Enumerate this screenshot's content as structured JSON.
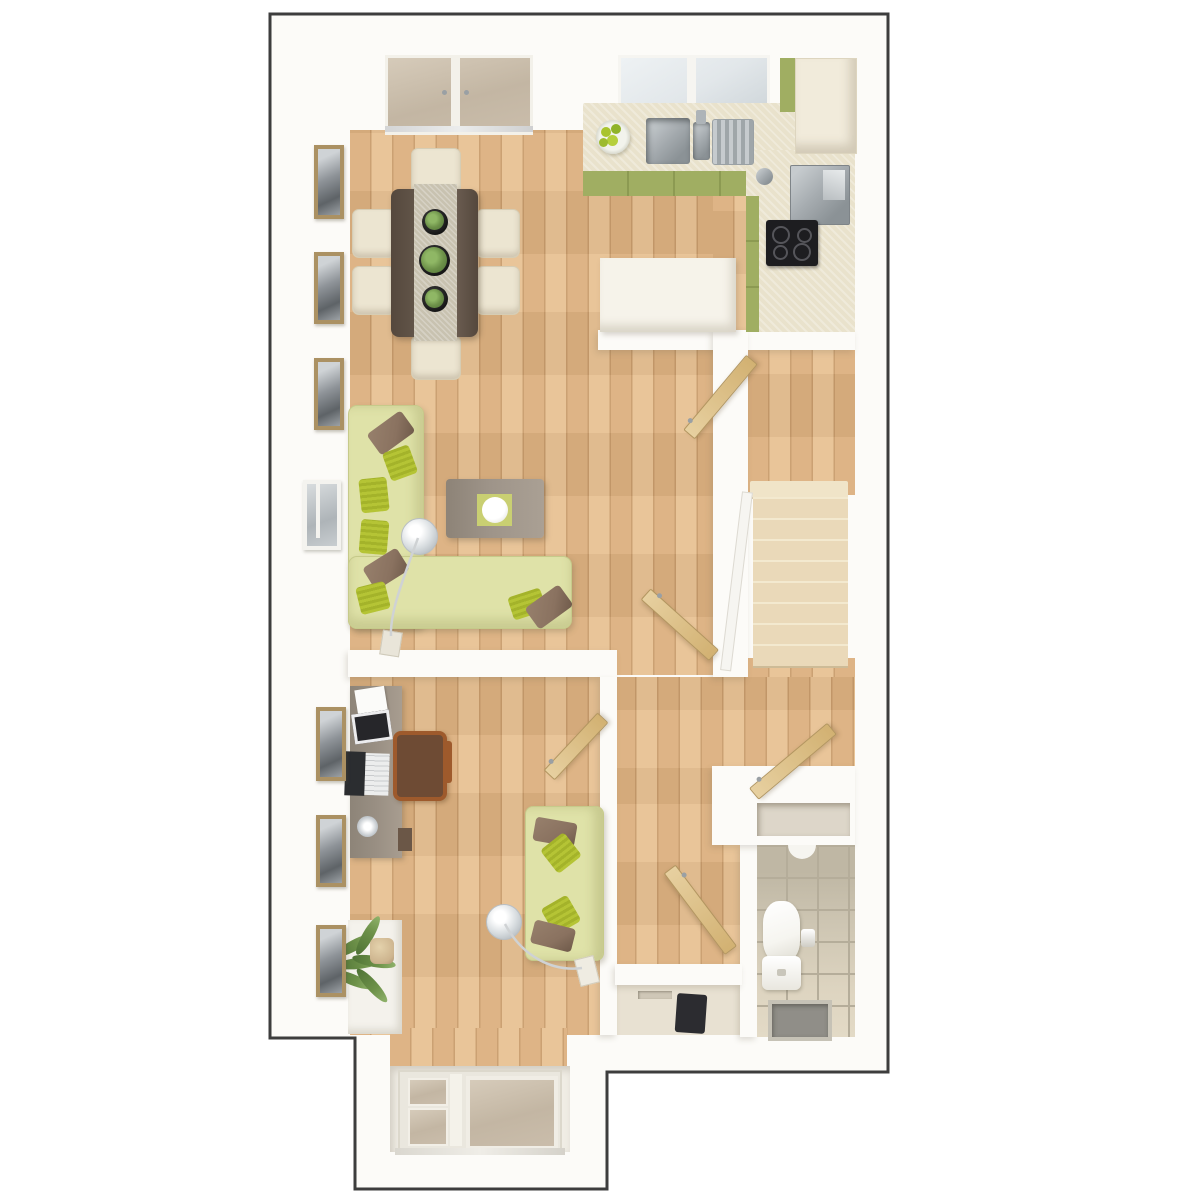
{
  "scene": {
    "kind": "3d-floor-plan-render",
    "no_visible_text": true,
    "stairs_step_count": 8,
    "dining_chair_count": 6,
    "table_plant_count": 3,
    "internal_open_door_count": 5,
    "left_wall_framed_window_count": 6
  },
  "palette": {
    "wall": "#fcfbf8",
    "outline": "#3d3d3d",
    "wood": "#dcb07f",
    "wood_hi": "#e8c294",
    "wood_line": "#c89c6c",
    "carpet": "#ead9b9",
    "carpet_edge": "#cdbb97",
    "counter": "#e9e2cc",
    "peninsula": "#f6f3ea",
    "cabinet_green": "#a0ae62",
    "cream_unit": "#f1ebdb",
    "steel": "#a7adb1",
    "steel_dark": "#8b9296",
    "hob": "#1d1d20",
    "glass_cool": "#e2e7ea",
    "glass_warm": "#c3b6a3",
    "sofa": "#dfe2a8",
    "sofa_edge": "#c6ca8a",
    "cushion_lime": "#b5c435",
    "cushion_brown": "#8a7260",
    "table_dark": "#63564a",
    "runner": "#c8c2b0",
    "chair_cream": "#ece5d1",
    "coffee_table": "#9e9489",
    "coffee_mat": "#c9cf72",
    "door_tan_1": "#e7d0a0",
    "door_tan_2": "#d2b172",
    "door_edge": "#b29660",
    "desk": "#998f83",
    "chair_wood": "#9e5a2c",
    "chair_seat": "#6e4b34",
    "tile": "#cdc5b2",
    "tile_grout": "#b5ad9a",
    "tile_floor": "#ddd4c0",
    "porcelain": "#f6f5f0",
    "mat_gray": "#908e88",
    "mat_dark": "#2c2c30",
    "plant": "#6d9149",
    "plant_dark": "#4f7336",
    "frame_gold": "#ab9163",
    "art_gray": "#8e9398",
    "lamp": "#d7dcdf",
    "smallroom_floor": "#e8e1d2",
    "sill": "#f4f2ec"
  },
  "rooms": [
    {
      "id": "kitchen",
      "furniture": [
        "worktop",
        "double-bowl-sink",
        "drainer",
        "tap",
        "fruit-bowl",
        "hob",
        "oven",
        "tall-fridge-unit",
        "green-base-cabinets",
        "peninsula-counter",
        "kitchen-window"
      ]
    },
    {
      "id": "dining-area",
      "furniture": [
        "dining-table",
        "table-runner",
        "3-potted-plants",
        "6-cream-chairs",
        "french-doors"
      ]
    },
    {
      "id": "living-area",
      "furniture": [
        "l-shaped-corner-sofa",
        "scatter-cushions",
        "coffee-table",
        "bowl",
        "arc-floor-lamp"
      ]
    },
    {
      "id": "stair-hall",
      "furniture": [
        "staircase-8-steps",
        "white-balustrade",
        "kitchen-door",
        "living-room-door",
        "understairs-door",
        "understairs-cupboard-niche"
      ]
    },
    {
      "id": "study",
      "furniture": [
        "desk",
        "laptop",
        "papers",
        "tablet",
        "desk-lamp-base",
        "wooden-office-chair",
        "two-seat-sofa",
        "arc-floor-lamp",
        "palm-plant",
        "window-sill"
      ]
    },
    {
      "id": "cloakroom-wc",
      "furniture": [
        "toilet",
        "cistern",
        "toilet-roll-holder",
        "recessed-mat",
        "basin-edge"
      ]
    },
    {
      "id": "store-lobby",
      "furniture": [
        "dark-doormat",
        "floor-vent"
      ]
    },
    {
      "id": "porch",
      "furniture": [
        "glazed-front-door",
        "glazed-sidelight"
      ]
    }
  ]
}
